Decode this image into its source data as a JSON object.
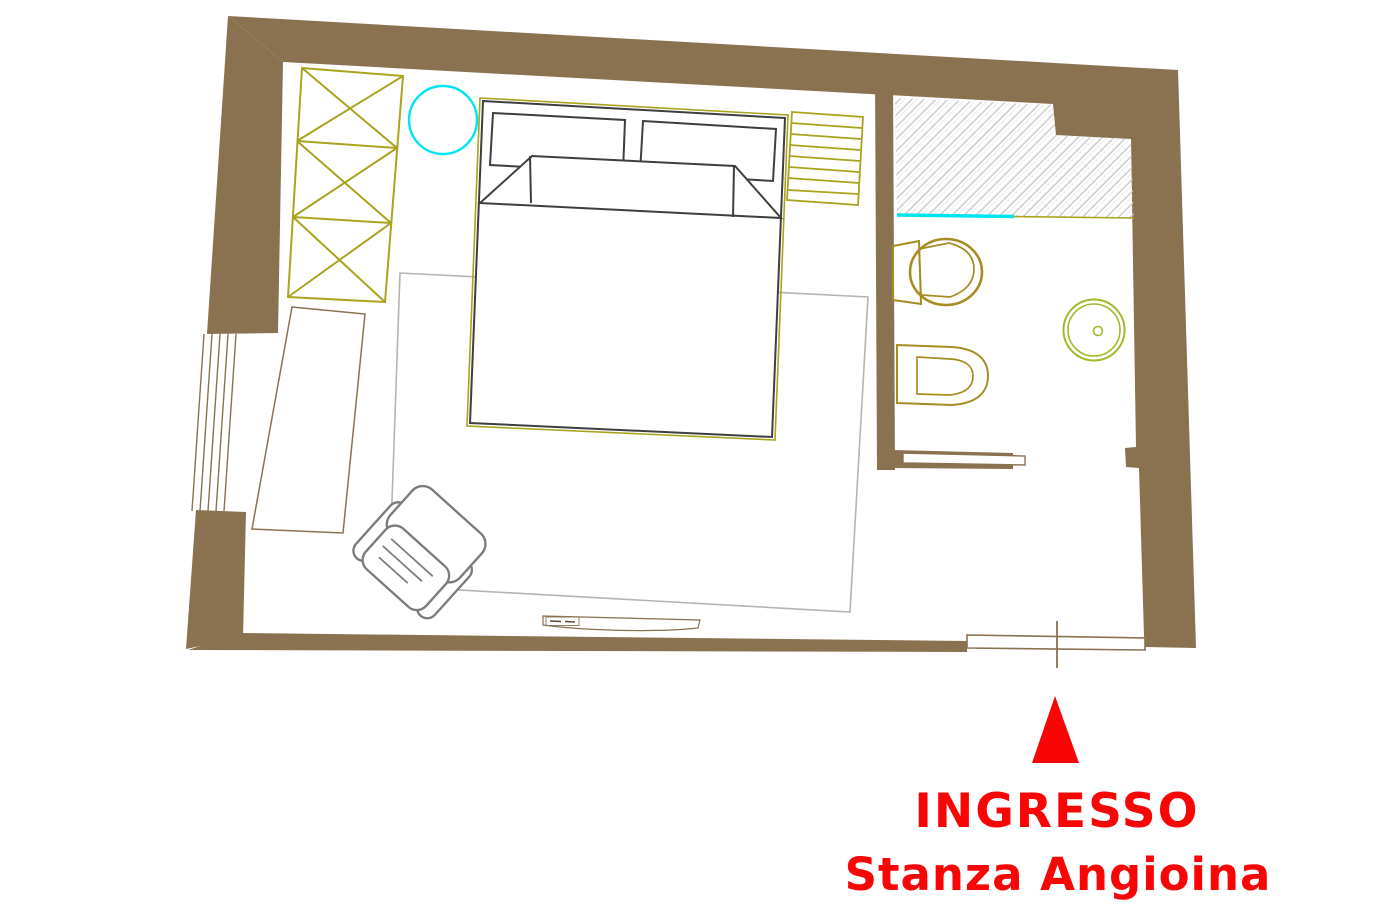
{
  "page": {
    "background": "#ffffff",
    "type": "floor-plan-drawing"
  },
  "labels": {
    "entrance": "INGRESSO",
    "room_name": "Stanza Angioina"
  },
  "colors": {
    "paper": "#ffffff",
    "wall": "#8a7150",
    "olive": "#a9a31e",
    "gold": "#a58c23",
    "green": "#9fb929",
    "cyan": "#00e4f2",
    "hatch": "#c8c8c8",
    "red": "#f90505",
    "sketch": "#7b7b7b",
    "rug": "#b4b4b4",
    "dark": "#3f3f3f"
  },
  "furniture_icons": [
    "wardrobe-icon",
    "stool-icon",
    "double-bed-icon",
    "nightstand-icon",
    "shower-area-icon",
    "toilet-icon",
    "bidet-icon",
    "washbasin-icon",
    "bench-shelf-icon",
    "desk-icon",
    "window-icon",
    "armchair-icon",
    "rug-icon",
    "radiator-icon",
    "entrance-door-icon",
    "entrance-arrow-icon"
  ]
}
